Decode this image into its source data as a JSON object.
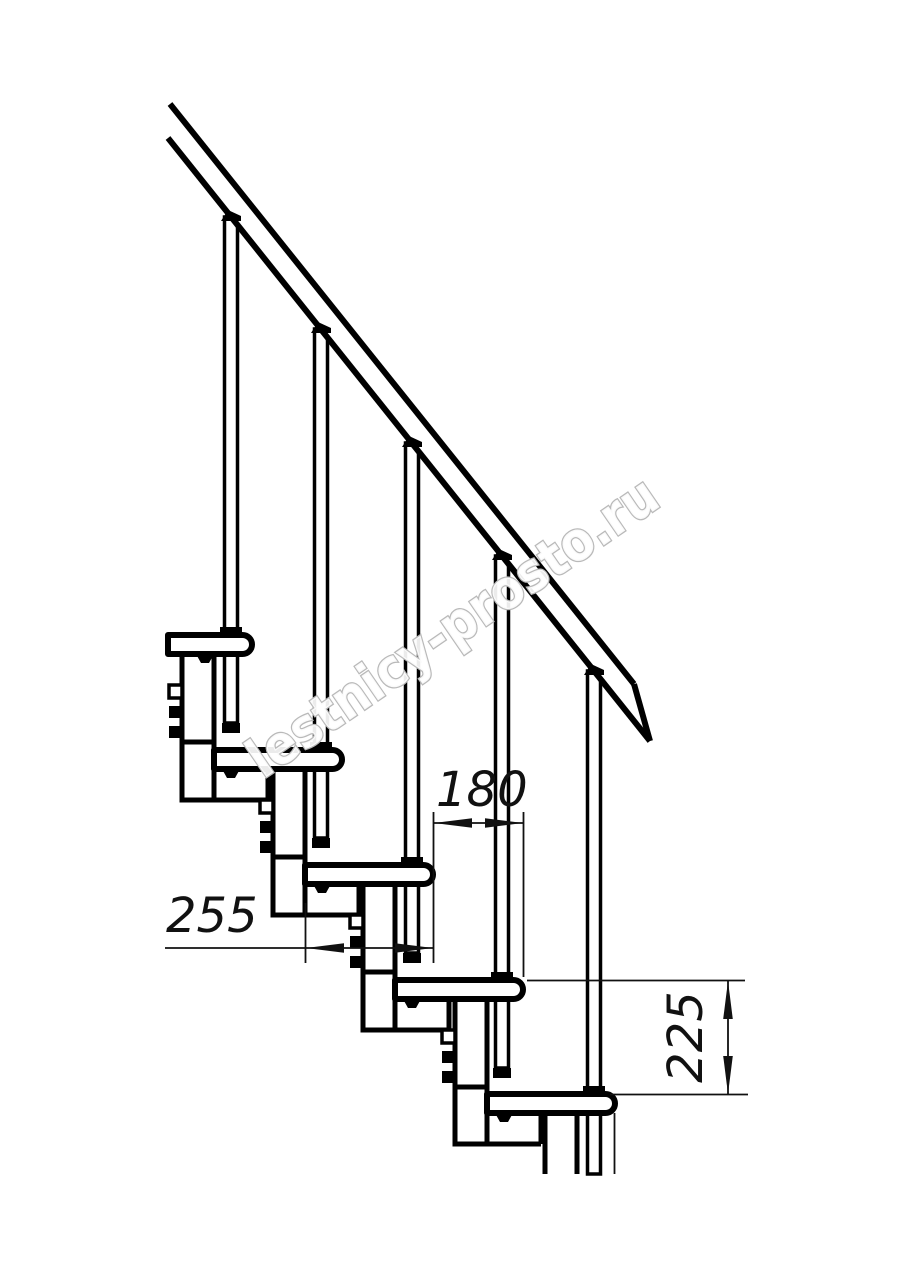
{
  "drawing": {
    "name": "modular-staircase-side-elevation",
    "background": "#ffffff",
    "line_color": "#000000",
    "dimension_color": "#111111",
    "watermark": {
      "text": "lestnicy-prosto.ru",
      "outline_color": "#b9b9b9",
      "fill_color": "#ffffff"
    },
    "dimensions": [
      {
        "id": "step-going",
        "value": "180",
        "orientation": "horizontal"
      },
      {
        "id": "tread-depth",
        "value": "255",
        "orientation": "horizontal"
      },
      {
        "id": "riser-height",
        "value": "225",
        "orientation": "vertical"
      }
    ],
    "parts": {
      "treads": 5,
      "balusters": 5,
      "support_modules": 5,
      "handrail": 1
    }
  }
}
